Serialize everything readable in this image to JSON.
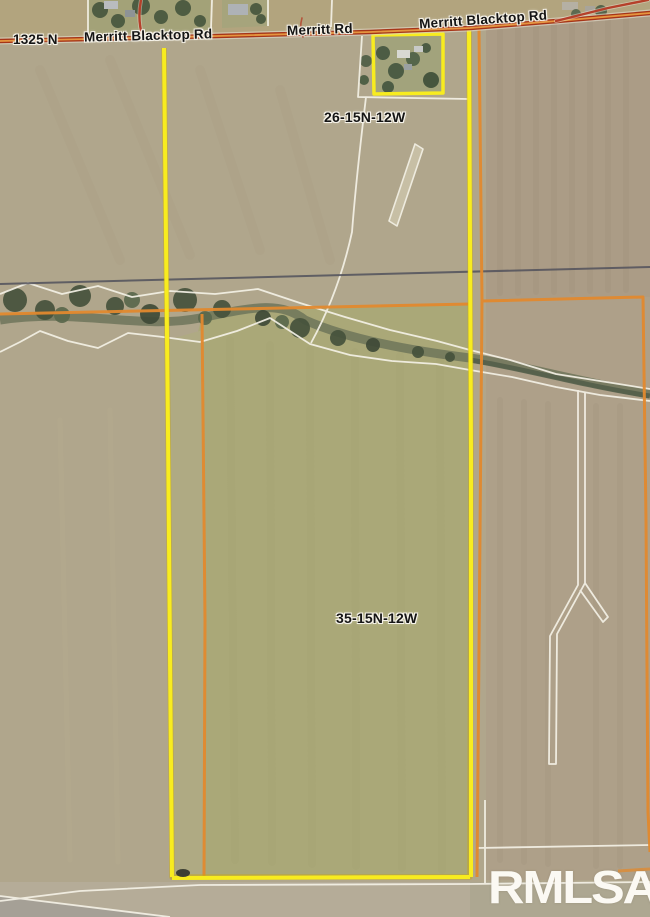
{
  "map": {
    "road_labels": [
      {
        "text": "1325 N"
      },
      {
        "text": "Merritt Blacktop Rd"
      },
      {
        "text": "Merritt Rd"
      },
      {
        "text": "Merritt Blacktop Rd"
      }
    ],
    "section_labels": [
      {
        "text": "26-15N-12W"
      },
      {
        "text": "35-15N-12W"
      }
    ],
    "watermark": {
      "text": "RMLSA"
    },
    "colors": {
      "parcel_yellow": "#f8ec1f",
      "boundary_orange": "#e2892e",
      "road_red": "#a63518",
      "road_center_orange": "#e5953f",
      "section_line_gray": "#52525c",
      "parcel_line_white": "#f4f1e6",
      "field_tan": "#b0a68c",
      "field_olive": "#aaa878",
      "field_gray_brown": "#ab9c86",
      "creek_green": "#57644c",
      "watermark_white": "#fbf9f3"
    }
  }
}
